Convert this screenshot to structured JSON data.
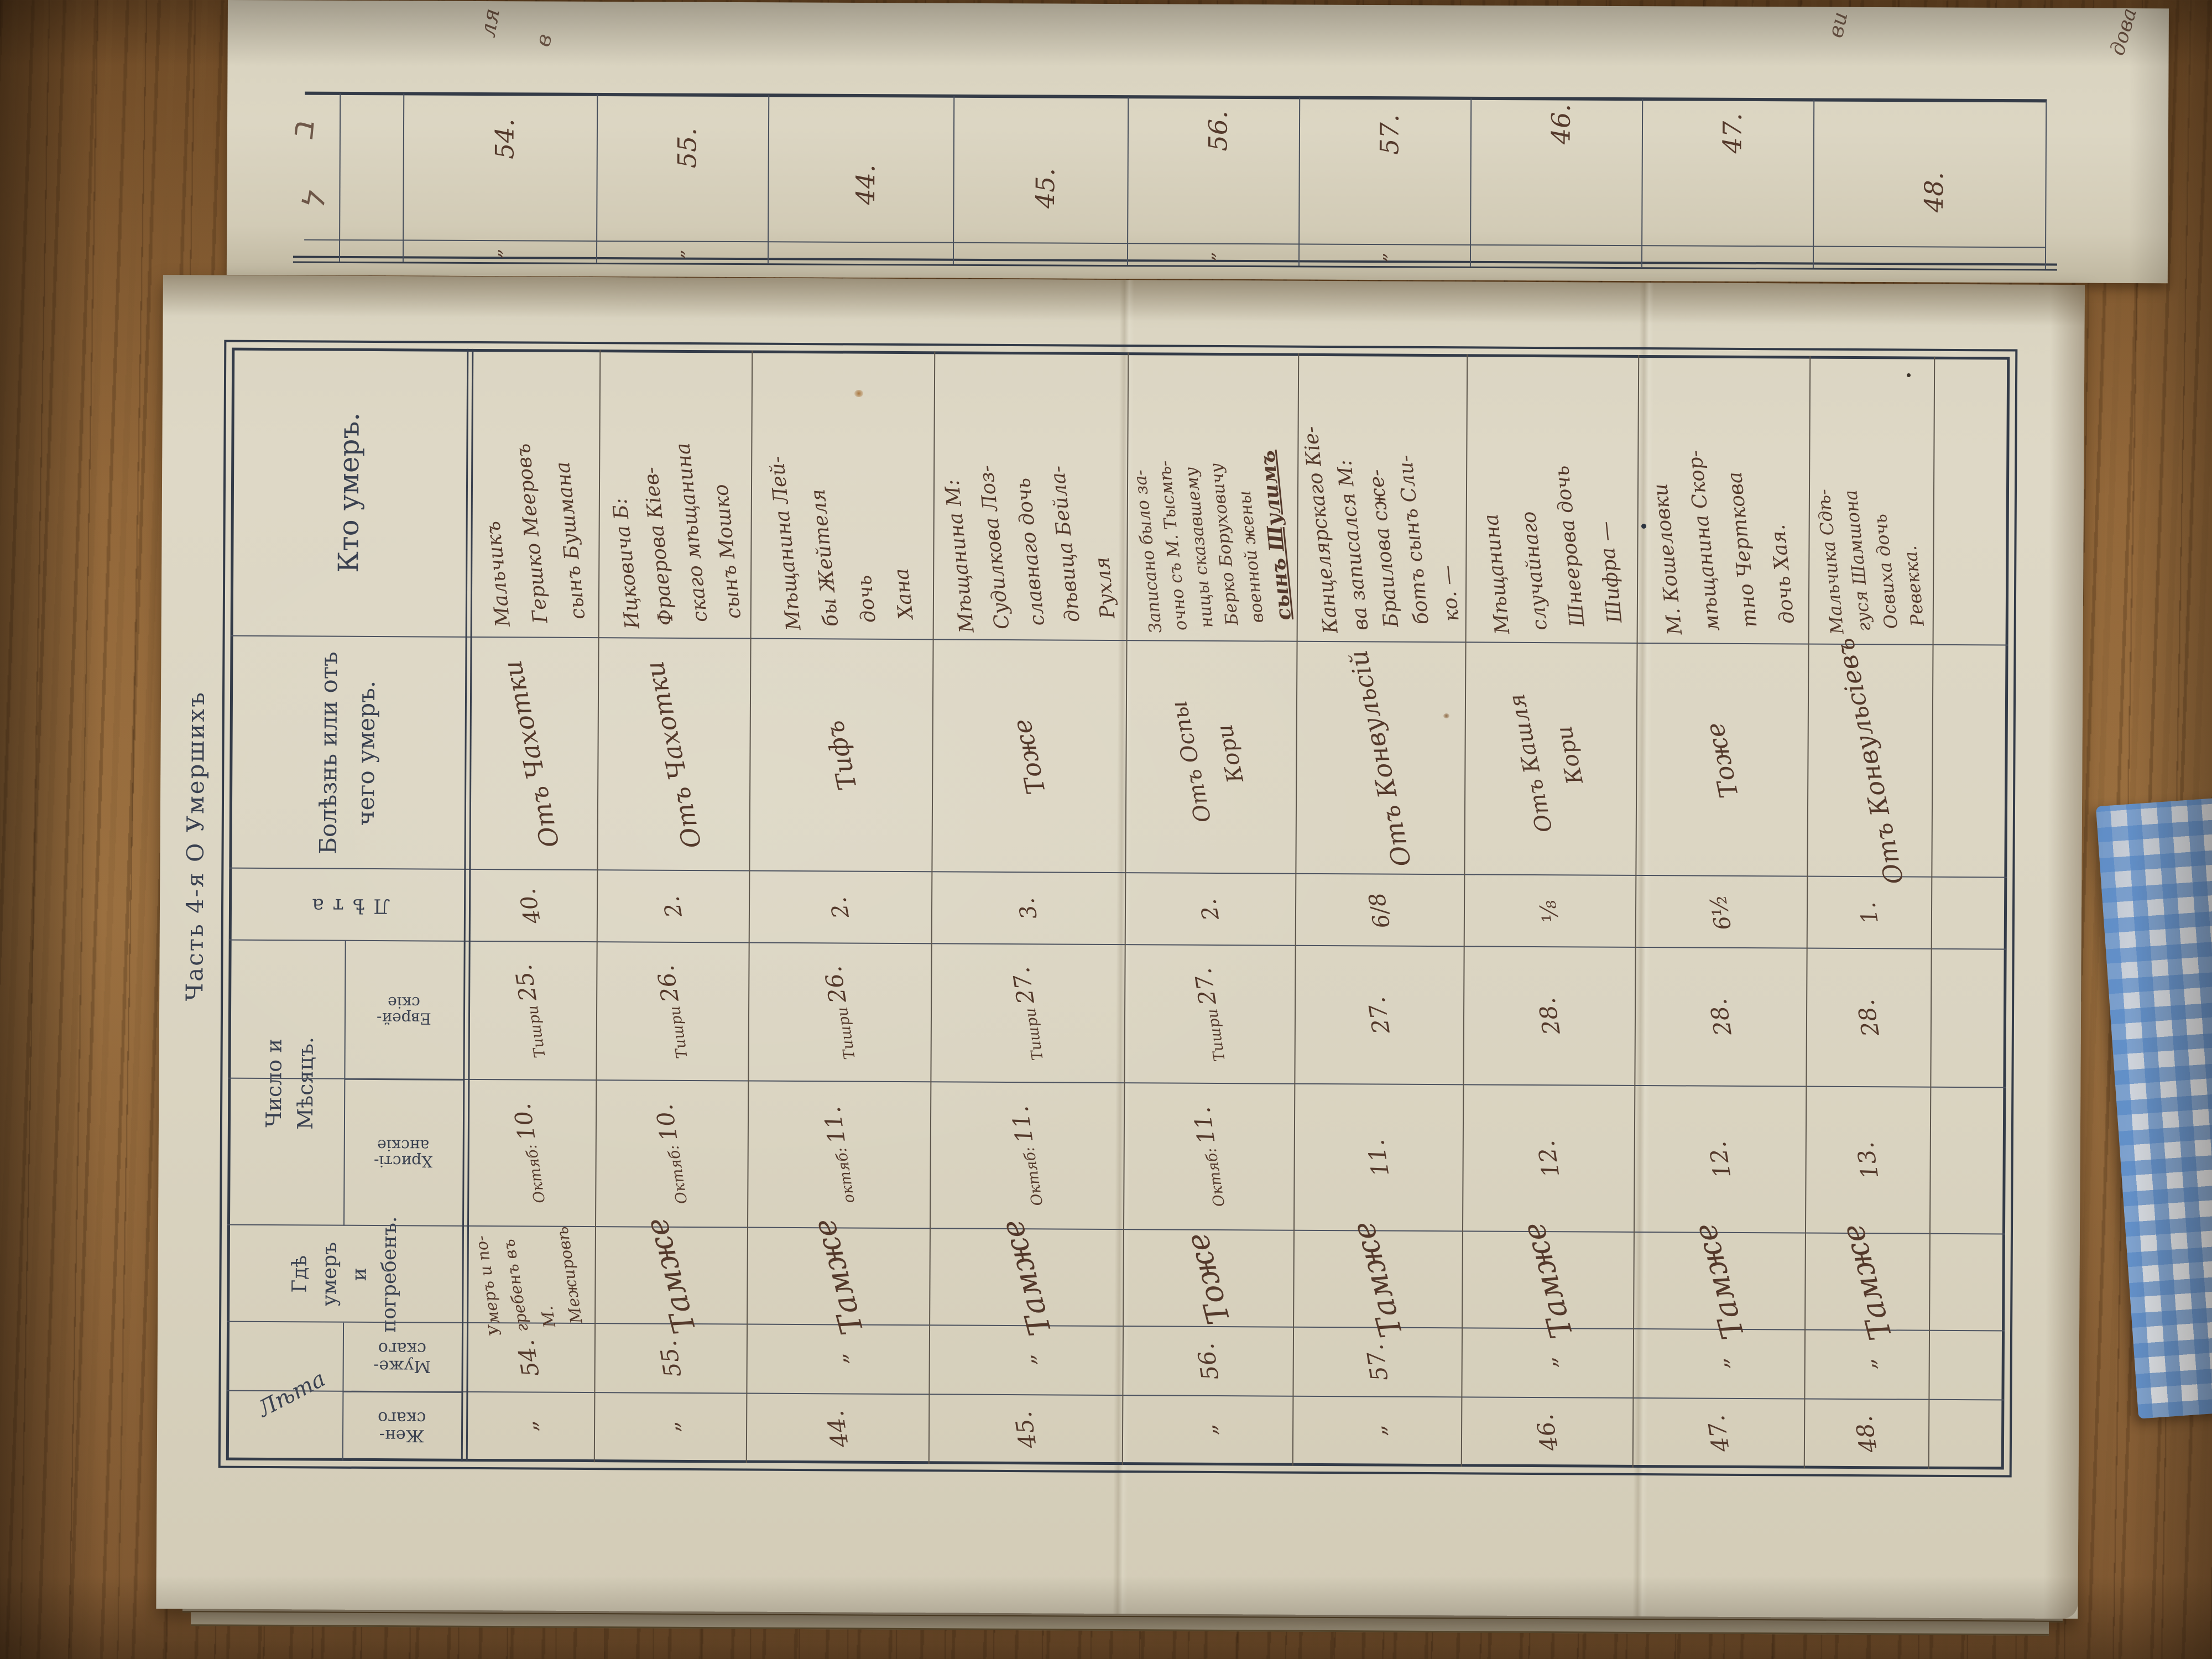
{
  "palette": {
    "wood": "#8a6138",
    "paper": "#dbd5c2",
    "paper_shadow": "#bfb7a0",
    "ink": "#54392b",
    "print_ink": "#3a4150",
    "rule_line": "#4d5360",
    "cloth_blue": "#5688c6",
    "cloth_white": "#eceff2"
  },
  "page_label": {
    "text": "Часть 4-я     О Умершихъ"
  },
  "table_headers": {
    "who": "Кто умеръ.",
    "disease": [
      "Болѣзнь или отъ",
      "чего умеръ."
    ],
    "age_vertical": "Лѣта",
    "date_group": [
      "Число и",
      "Мѣсяцъ."
    ],
    "date_sub_christian": [
      "Христі-",
      "анскіе"
    ],
    "date_sub_jewish": [
      "Еврей-",
      "скіе"
    ],
    "place": [
      "Гдѣ умеръ",
      "и погребенъ."
    ],
    "count_group": "Лѣта",
    "count_sub_male": [
      "Муже-",
      "скаго"
    ],
    "count_sub_female": [
      "Жен-",
      "скаго"
    ]
  },
  "ditto": "„",
  "records": [
    {
      "count_male": "54.",
      "count_female": "„",
      "place_lines": [
        "Умеръ и по-",
        "гребенъ въ М.",
        "Межировѣ"
      ],
      "date_christian_label": "Октяб:",
      "date_christian_day": "10.",
      "date_jewish_label": "Тишри",
      "date_jewish_day": "25.",
      "age": "40.",
      "disease_lines": [
        "Отъ Чахотки"
      ],
      "who_lines": [
        "Мальчикъ",
        "Гершко Мееровъ",
        "сынъ Бушмана"
      ]
    },
    {
      "count_male": "55.",
      "count_female": "„",
      "place_lines": [
        "Тамже"
      ],
      "date_christian_label": "Октяб:",
      "date_christian_day": "10.",
      "date_jewish_label": "Тишри",
      "date_jewish_day": "26.",
      "age": "2.",
      "disease_lines": [
        "Отъ Чахотки"
      ],
      "who_lines": [
        "Ицковича Б:",
        "Фраерова Кіев-",
        "скаго мѣщанина",
        "сынъ Мошко"
      ]
    },
    {
      "count_male": "„",
      "count_female": "44.",
      "place_lines": [
        "Тамже"
      ],
      "date_christian_label": "октяб:",
      "date_christian_day": "11.",
      "date_jewish_label": "Тишри",
      "date_jewish_day": "26.",
      "age": "2.",
      "disease_lines": [
        "Тифъ"
      ],
      "who_lines": [
        "Мѣщанина Лей-",
        "бы Жейтеля",
        "дочь",
        "Хана"
      ]
    },
    {
      "count_male": "„",
      "count_female": "45.",
      "place_lines": [
        "Тамже"
      ],
      "date_christian_label": "Октяб:",
      "date_christian_day": "11.",
      "date_jewish_label": "Тишри",
      "date_jewish_day": "27.",
      "age": "3.",
      "disease_lines": [
        "Тоже"
      ],
      "who_lines": [
        "Мѣщанина М:",
        "Судилкова Лоз-",
        "славнаго дочь",
        "дѣвица Бейла-",
        "Рухля"
      ]
    },
    {
      "count_male": "56.",
      "count_female": "„",
      "place_lines": [
        "Тоже"
      ],
      "date_christian_label": "Октяб:",
      "date_christian_day": "11.",
      "date_jewish_label": "Тишри",
      "date_jewish_day": "27.",
      "age": "2.",
      "disease_lines": [
        "Отъ Оспы",
        "Кори"
      ],
      "who_lines": [
        "Записано было за-",
        "очно съ М. Тысмѣ-",
        "ницы сказавшему",
        "Берко Боруховичу",
        "военной жены",
        "сынъ Шулимъ"
      ]
    },
    {
      "count_male": "57.",
      "count_female": "„",
      "place_lines": [
        "Тамже"
      ],
      "date_christian_label": "",
      "date_christian_day": "11.",
      "date_jewish_label": "",
      "date_jewish_day": "27.",
      "age": "6/8",
      "disease_lines": [
        "Отъ Конвульсій"
      ],
      "who_lines": [
        "Канцелярскаго Кіе-",
        "ва записался М:",
        "Браилова сже-",
        "ботъ сынъ Сли-",
        "ко. —"
      ]
    },
    {
      "count_male": "„",
      "count_female": "46.",
      "place_lines": [
        "Тамже"
      ],
      "date_christian_label": "",
      "date_christian_day": "12.",
      "date_jewish_label": "",
      "date_jewish_day": "28.",
      "age": "⅛",
      "disease_lines": [
        "Отъ Кашля",
        "Кори"
      ],
      "who_lines": [
        "Мѣщанина",
        "случайнаго",
        "Шнеерова дочь",
        "Шифра —"
      ]
    },
    {
      "count_male": "„",
      "count_female": "47.",
      "place_lines": [
        "Тамже"
      ],
      "date_christian_label": "",
      "date_christian_day": "12.",
      "date_jewish_label": "",
      "date_jewish_day": "28.",
      "age": "6½",
      "disease_lines": [
        "Тоже"
      ],
      "who_lines": [
        "М. Кошеловки",
        "мѣщанина Скор-",
        "тно Черткова",
        "дочь Хая."
      ]
    },
    {
      "count_male": "„",
      "count_female": "48.",
      "place_lines": [
        "Тамже"
      ],
      "date_christian_label": "",
      "date_christian_day": "13.",
      "date_jewish_label": "",
      "date_jewish_day": "28.",
      "age": "1.",
      "disease_lines": [
        "Отъ Конвульсіевъ"
      ],
      "who_lines": [
        "Мальчика Сдѣ-",
        "гуся Шамшона",
        "Освиха дочь",
        "Ревекка."
      ]
    }
  ],
  "top_strip": {
    "cells": [
      {
        "number": "54.",
        "ditto": "„"
      },
      {
        "number": "55.",
        "ditto": "„"
      },
      {
        "number": "44.",
        "ditto": ""
      },
      {
        "number": "45.",
        "ditto": ""
      },
      {
        "number": "56.",
        "ditto": "„"
      },
      {
        "number": "57.",
        "ditto": "„"
      },
      {
        "number": "46.",
        "ditto": ""
      },
      {
        "number": "47.",
        "ditto": ""
      },
      {
        "number": "48.",
        "ditto": ""
      }
    ],
    "edge_fragments": [
      "ля",
      "в",
      "ви",
      "дова"
    ],
    "header_marks": [
      "ב",
      "ל"
    ]
  }
}
